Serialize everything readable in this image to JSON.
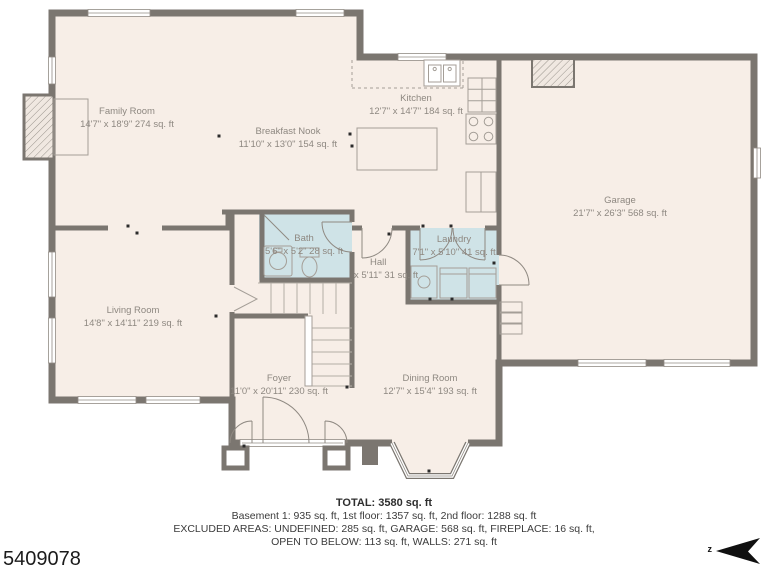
{
  "plan": {
    "id_number": "5409078",
    "compass_letter": "z",
    "rooms": [
      {
        "name": "Family Room",
        "dims": "14'7\" x 18'9\" 274 sq. ft"
      },
      {
        "name": "Breakfast Nook",
        "dims": "11'10\" x 13'0\" 154 sq. ft"
      },
      {
        "name": "Kitchen",
        "dims": "12'7\" x 14'7\" 184 sq. ft"
      },
      {
        "name": "Garage",
        "dims": "21'7\" x 26'3\" 568 sq. ft"
      },
      {
        "name": "Living Room",
        "dims": "14'8\" x 14'11\" 219 sq. ft"
      },
      {
        "name": "Bath",
        "dims": "5'6\" x 5'2\" 28 sq. ft"
      },
      {
        "name": "Hall",
        "dims": "x 5'11\" 31 sq. ft"
      },
      {
        "name": "Laundry",
        "dims": "7'1\" x 5'10\" 41 sq. ft"
      },
      {
        "name": "Foyer",
        "dims": "11'0\" x 20'11\" 230 sq. ft"
      },
      {
        "name": "Dining Room",
        "dims": "12'7\" x 15'4\" 193 sq. ft"
      }
    ],
    "summary": {
      "total": "TOTAL: 3580 sq. ft",
      "floors": "Basement 1: 935 sq. ft, 1st floor: 1357 sq. ft, 2nd floor: 1288 sq. ft",
      "excluded1": "EXCLUDED AREAS: UNDEFINED: 285 sq. ft, GARAGE: 568 sq. ft, FIREPLACE: 16 sq. ft,",
      "excluded2": "OPEN TO BELOW: 113 sq. ft, WALLS: 271 sq. ft"
    },
    "colors": {
      "wall": "#7b7670",
      "floor": "#f7eee7",
      "wet_room": "#cfe3e7"
    }
  }
}
